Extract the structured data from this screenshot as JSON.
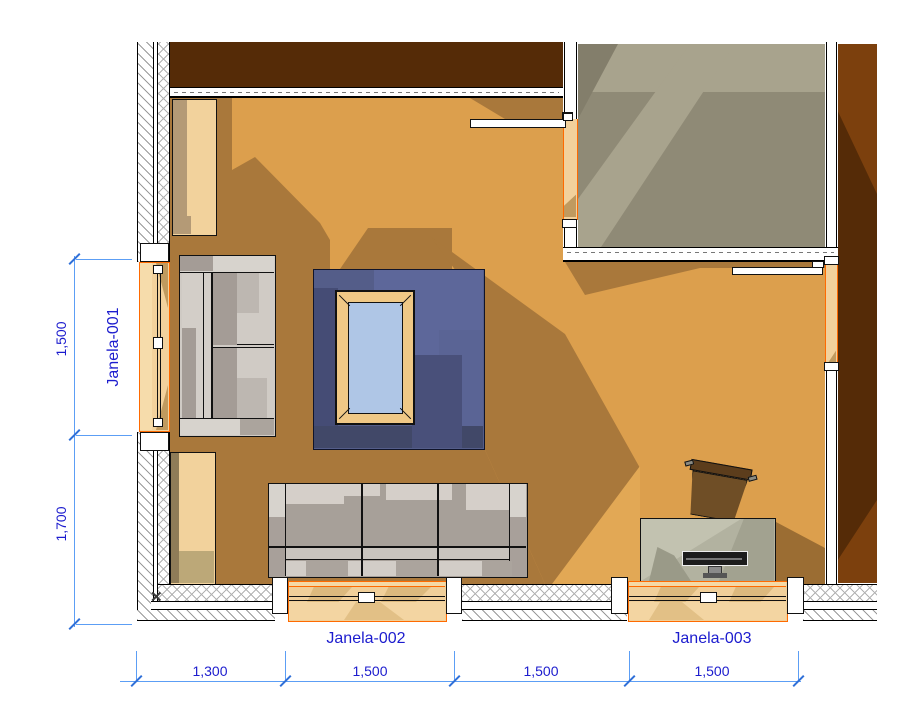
{
  "drawing": {
    "title_hint": "floor-plan",
    "marker": "✕",
    "windows": {
      "w1": {
        "label": "Janela-001"
      },
      "w2": {
        "label": "Janela-002"
      },
      "w3": {
        "label": "Janela-003"
      }
    },
    "dimensions": {
      "left": [
        "1,500",
        "1,700"
      ],
      "bottom": [
        "1,300",
        "1,500",
        "1,500",
        "1,500"
      ]
    },
    "colors": {
      "floor_light": "#DC9F4D",
      "floor_shadow": "#A9783B",
      "gray_floor": "#8F8A76",
      "wall_dark_brown": "#552B07",
      "opening_orange": "#FF6A00",
      "window_sill_tan": "#F2D19C",
      "rug_blue": "#545D89",
      "table_glass": "#AFC6E6",
      "table_wood": "#EFC886",
      "dim_line_blue": "#5C9EF5",
      "dim_text_blue": "#1C1CCE"
    }
  }
}
